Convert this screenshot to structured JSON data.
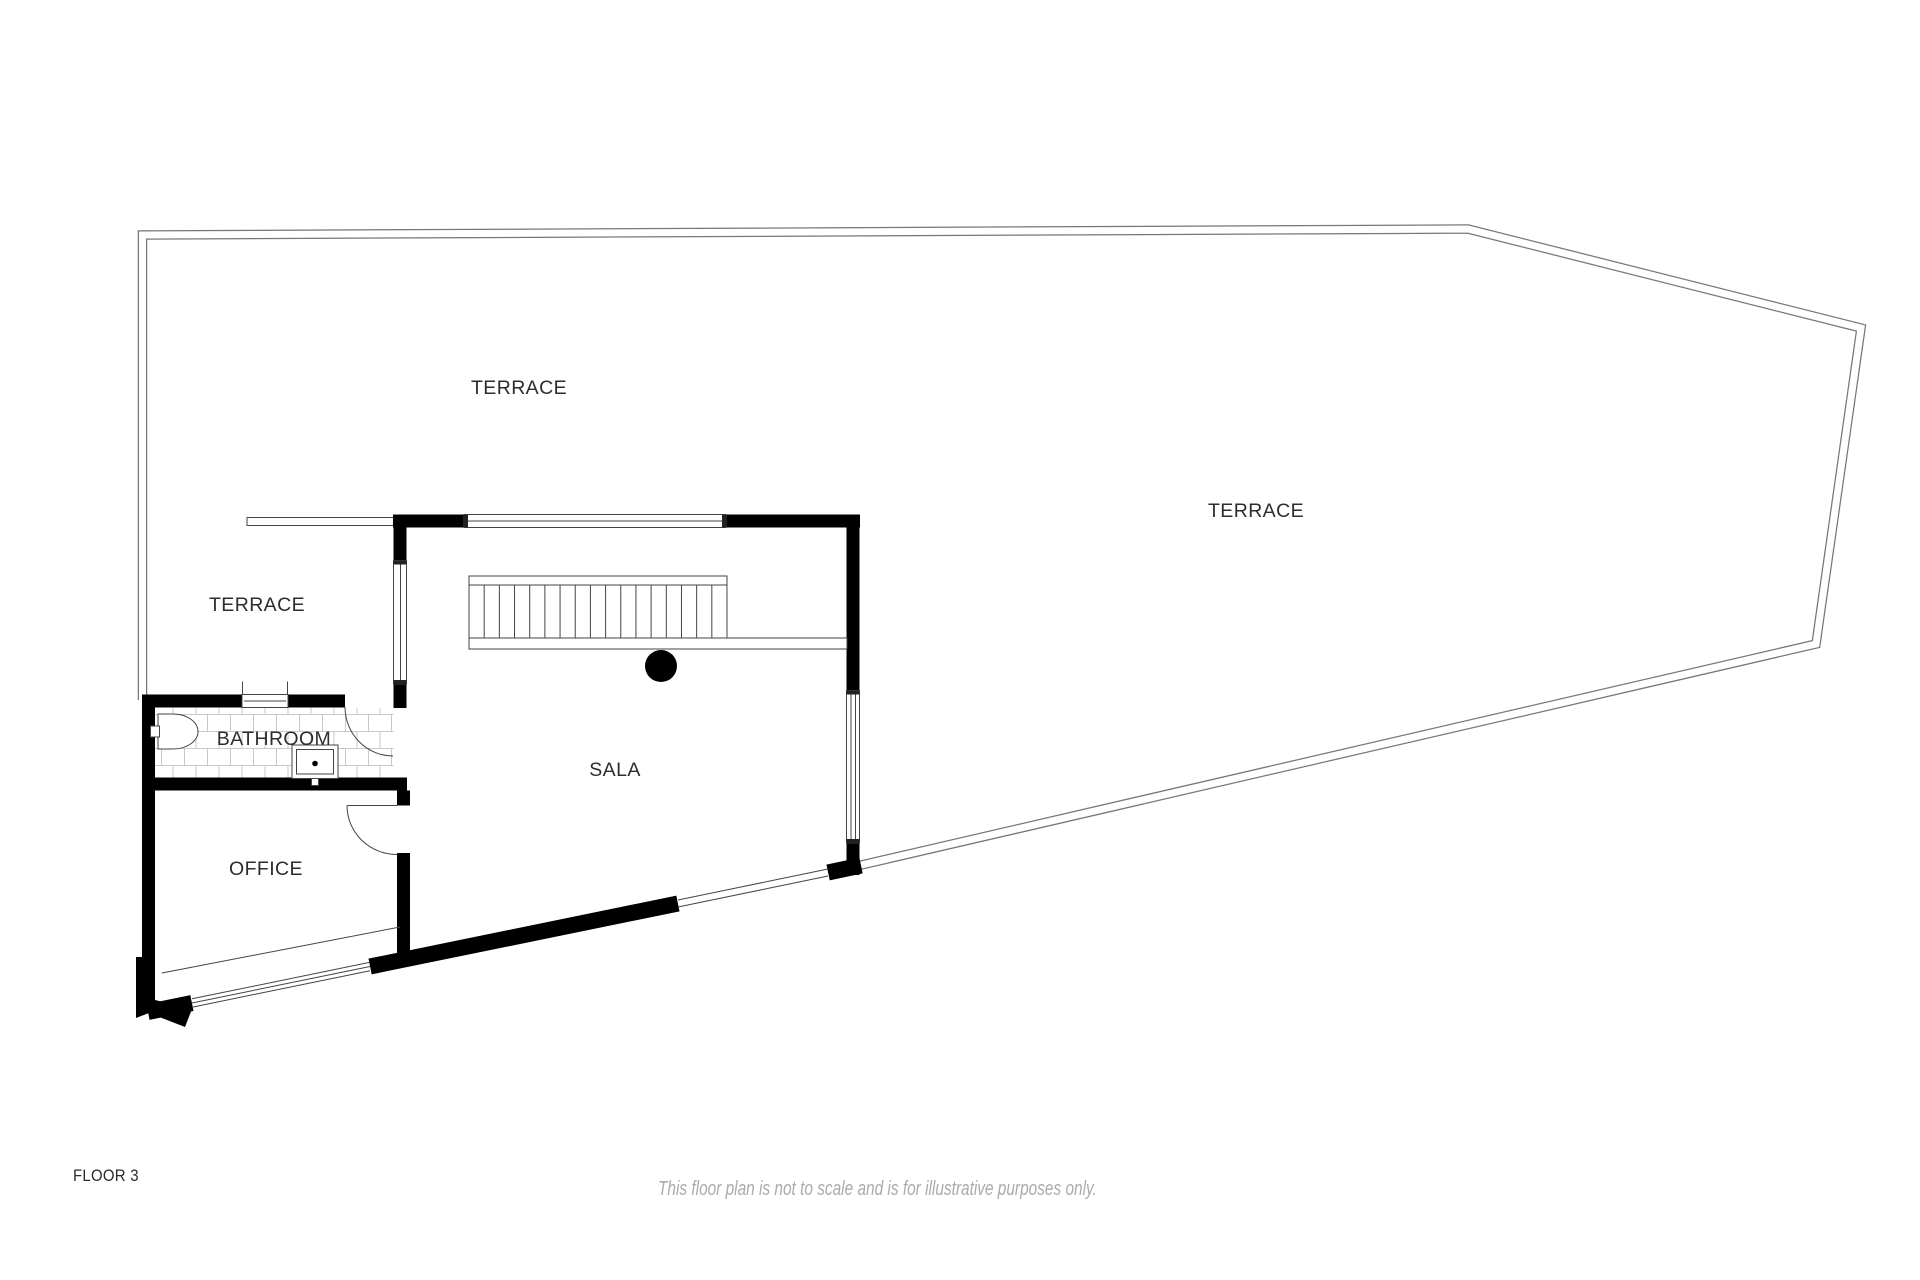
{
  "plan": {
    "rooms": [
      {
        "id": "terrace-top",
        "label": "TERRACE"
      },
      {
        "id": "terrace-right",
        "label": "TERRACE"
      },
      {
        "id": "terrace-left",
        "label": "TERRACE"
      },
      {
        "id": "bathroom",
        "label": "BATHROOM"
      },
      {
        "id": "sala",
        "label": "SALA"
      },
      {
        "id": "office",
        "label": "OFFICE"
      }
    ],
    "stairs": {
      "tread_count": 17
    }
  },
  "footer": {
    "floor_label": "FLOOR 3",
    "disclaimer": "This floor plan is not to scale and is for illustrative purposes only."
  },
  "colors": {
    "background": "#ffffff",
    "wall": "#000000",
    "line": "#444444",
    "boundary": "#777777",
    "tile_line": "#c9c9c9",
    "label": "#2d2d2d",
    "footer_text": "#2a2a2a",
    "disclaimer": "#ababab"
  }
}
